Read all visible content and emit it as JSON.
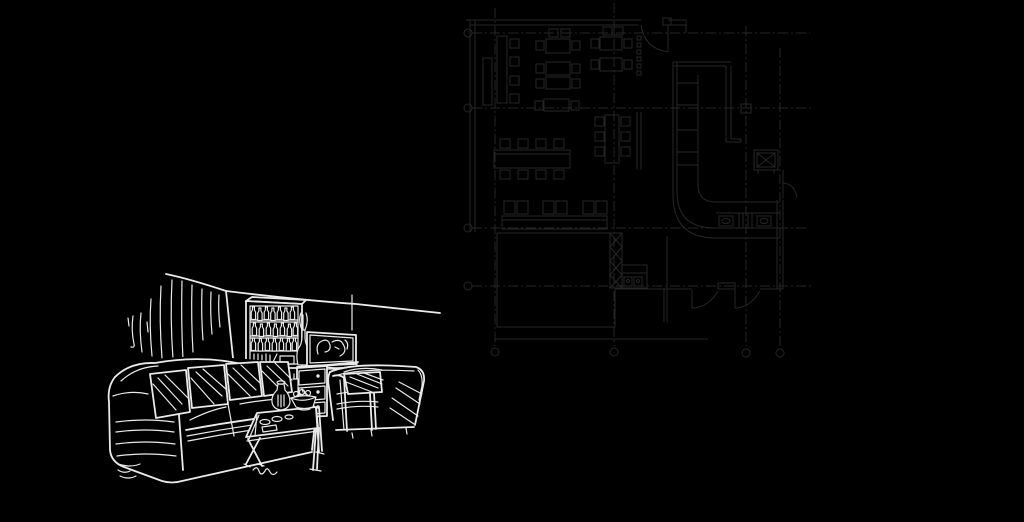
{
  "canvas": {
    "width": 1024,
    "height": 522
  },
  "colors": {
    "background": "#000000",
    "plan_line": "#262626",
    "sketch_line": "#eaeaea"
  },
  "floor_plan": {
    "label": "faint CAD floor plan of a cafe interior, upper right",
    "grid": {
      "vertical_axes_x": [
        495,
        614,
        746,
        780
      ],
      "horizontal_axes_y": [
        33,
        108,
        228,
        286
      ],
      "axis_marker": "circle"
    },
    "elements": [
      "outer-walls",
      "entry-door",
      "dining-tables-with-chairs",
      "long-tables",
      "banquet-table",
      "kitchen-room",
      "cross-hatched-wall",
      "kitchen-appliances",
      "bar-counter",
      "counter-equipment",
      "shaft-box-x",
      "swing-doors",
      "side-door"
    ]
  },
  "sketch": {
    "label": "white hand-drawn living room sketch, lower left",
    "objects": [
      "curtain",
      "back-wall",
      "display-cabinet",
      "bottles",
      "books",
      "tall-vase",
      "tv",
      "tv-doodle",
      "dresser",
      "drawer-knobs",
      "sofa",
      "striped-pillows",
      "armchair",
      "armchair-pillow",
      "coffee-table",
      "cups",
      "jug",
      "fruit-bowl",
      "signature-scribble"
    ]
  }
}
